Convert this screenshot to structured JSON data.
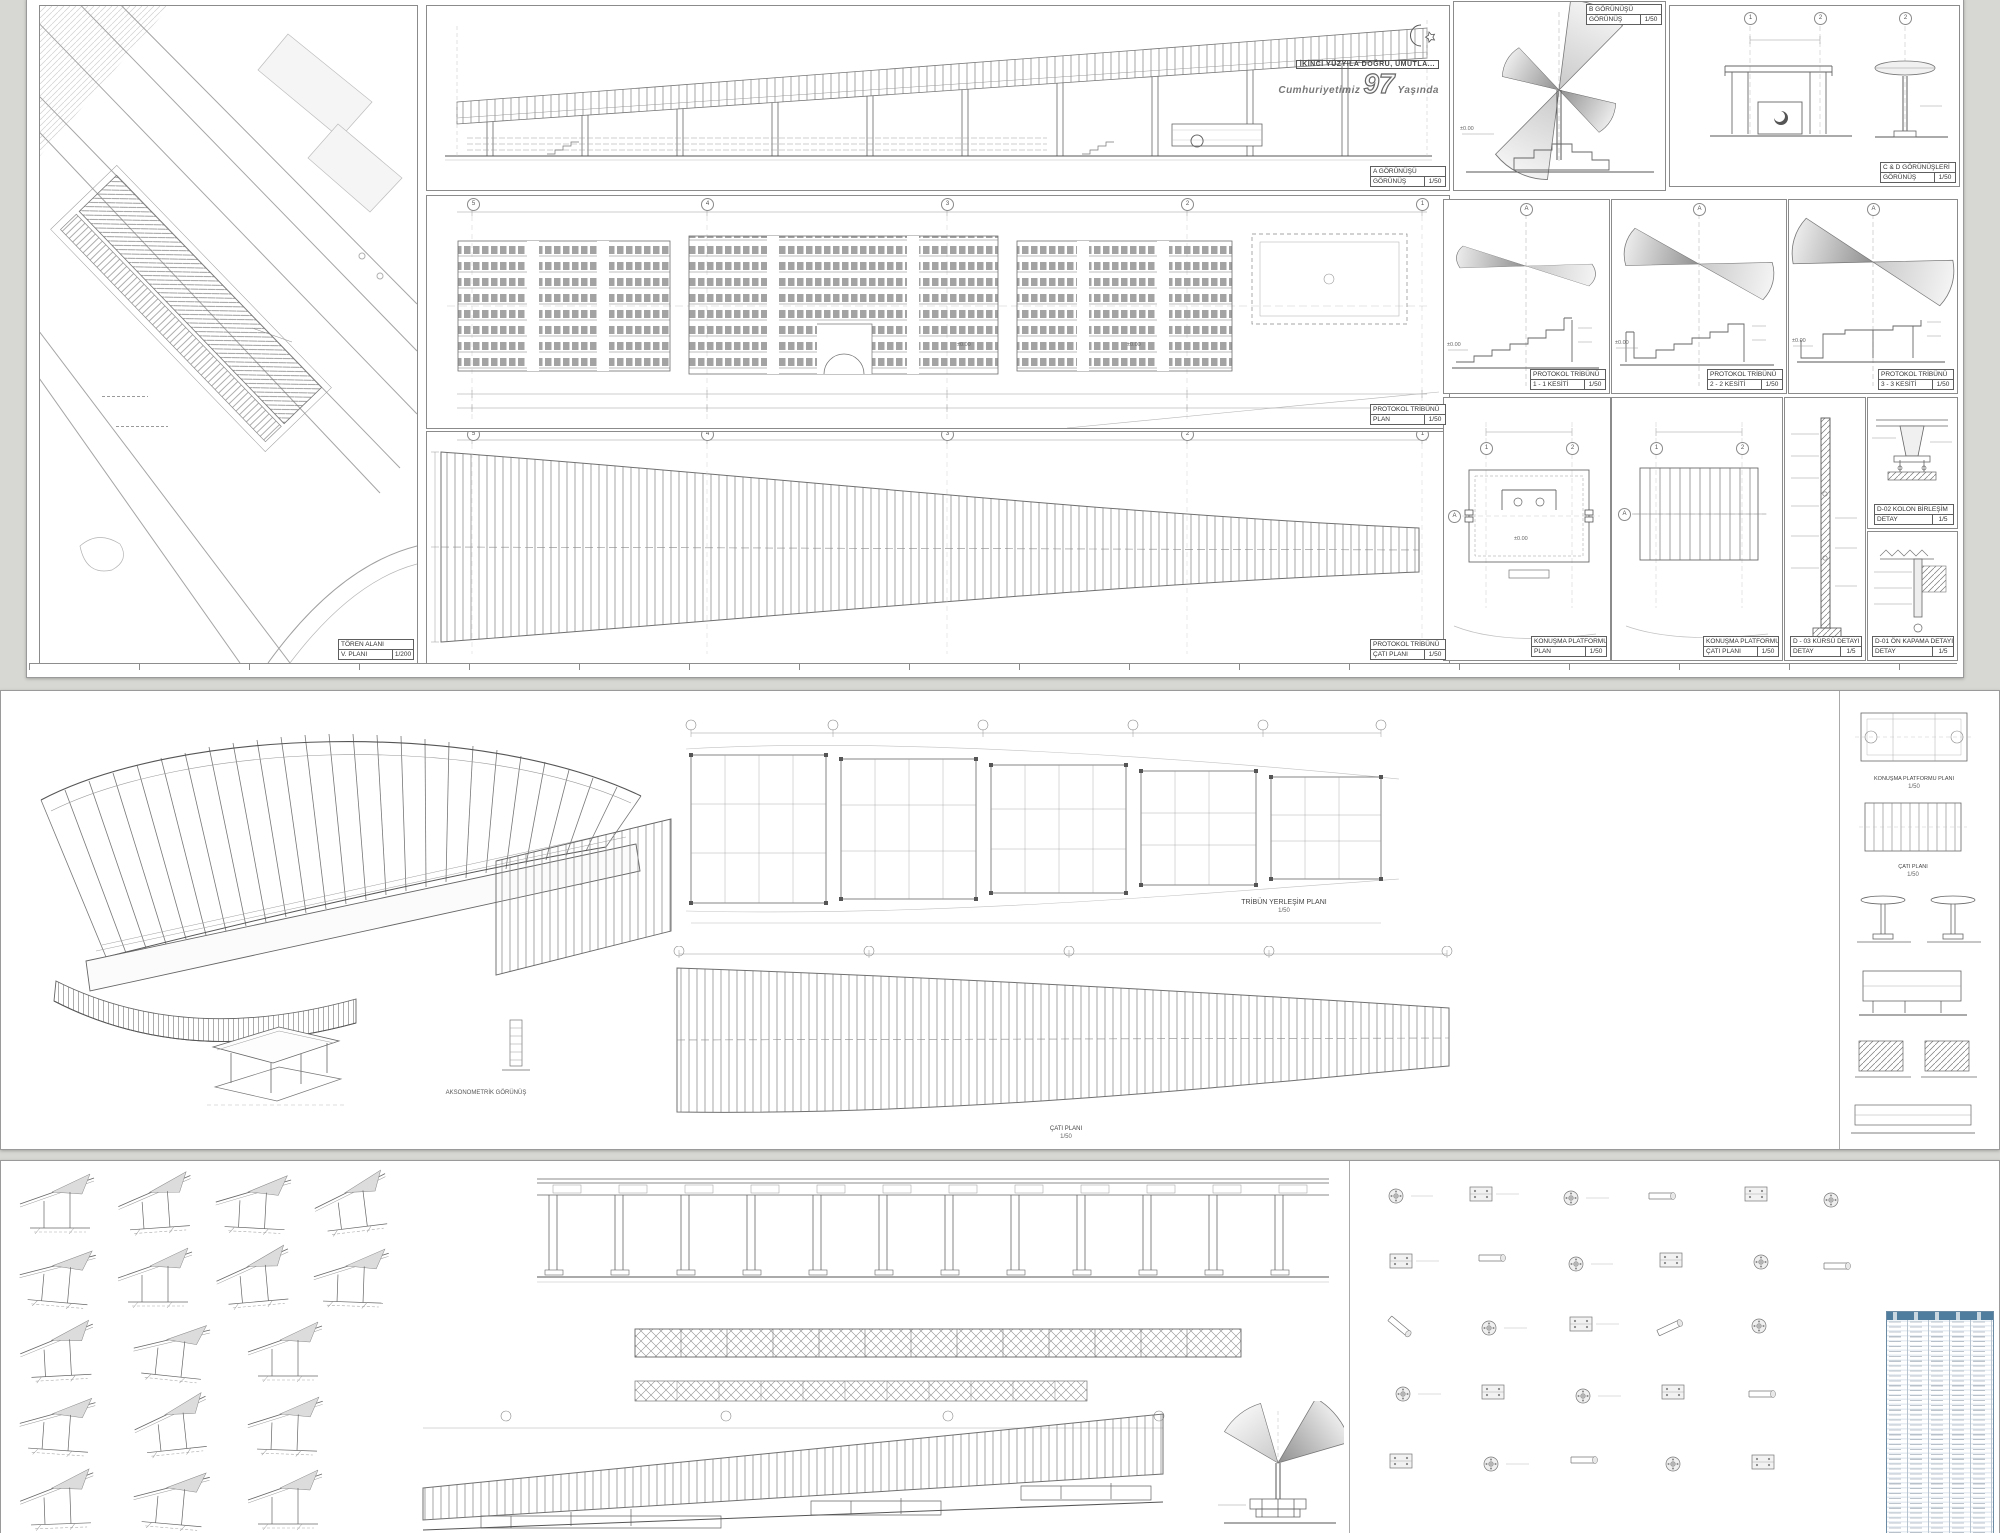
{
  "logo": {
    "slogan": "İKİNCİ YÜZYILA DOĞRU, UMUTLA...",
    "line1": "Cumhuriyetimiz",
    "number": "97",
    "line2": "Yaşında"
  },
  "levels": {
    "zero": "±0.00"
  },
  "sheet1": {
    "site": {
      "title": "TÖREN ALANI",
      "type": "V. PLANI",
      "scale": "1/200"
    },
    "elev_a": {
      "title": "A GÖRÜNÜŞÜ",
      "type": "GÖRÜNÜŞ",
      "scale": "1/50"
    },
    "plan": {
      "title": "PROTOKOL TRİBÜNÜ",
      "type": "PLAN",
      "scale": "1/50"
    },
    "roof": {
      "title": "PROTOKOL TRİBÜNÜ",
      "type": "ÇATI PLANI",
      "scale": "1/50"
    },
    "elev_b": {
      "title": "B GÖRÜNÜŞÜ",
      "type": "GÖRÜNÜŞ",
      "scale": "1/50"
    },
    "elev_cd": {
      "title": "C & D GÖRÜNÜŞLERİ",
      "type": "GÖRÜNÜŞ",
      "scale": "1/50"
    },
    "sec1": {
      "title": "PROTOKOL TRİBÜNÜ",
      "type": "1 - 1 KESİTİ",
      "scale": "1/50"
    },
    "sec2": {
      "title": "PROTOKOL TRİBÜNÜ",
      "type": "2 - 2 KESİTİ",
      "scale": "1/50"
    },
    "sec3": {
      "title": "PROTOKOL TRİBÜNÜ",
      "type": "3 - 3 KESİTİ",
      "scale": "1/50"
    },
    "kp_plan": {
      "title": "KONUŞMA PLATFORMU",
      "type": "PLAN",
      "scale": "1/50"
    },
    "kp_roof": {
      "title": "KONUŞMA PLATFORMU",
      "type": "ÇATI PLANI",
      "scale": "1/50"
    },
    "kursu": {
      "title": "D - 03 KÜRSÜ DETAYI",
      "type": "DETAY",
      "scale": "1/5"
    },
    "kolon": {
      "title": "D-02 KOLON BİRLEŞİM",
      "type": "DETAY",
      "scale": "1/5"
    },
    "kapama": {
      "title": "D-01 ÖN KAPAMA DETAYI",
      "type": "DETAY",
      "scale": "1/5"
    },
    "grid": {
      "g5": "5",
      "g4": "4",
      "g3": "3",
      "g2": "2",
      "g1": "1",
      "axis": "A",
      "p1": "1",
      "p2": "2"
    }
  },
  "sheet2": {
    "akso_label": "AKSONOMETRİK GÖRÜNÜŞ",
    "tribun_plan": {
      "title": "TRİBÜN YERLEŞİM PLANI",
      "scale": "1/50"
    },
    "roof_plan": {
      "title": "ÇATI PLANI",
      "scale": "1/50"
    },
    "kp_plan": {
      "title": "KONUŞMA PLATFORMU PLANI",
      "scale": "1/50"
    },
    "kp_roof": {
      "title": "ÇATI PLANI",
      "scale": "1/50"
    }
  },
  "sheet3": {
    "schedule": {
      "rows": 44,
      "columns": 5,
      "header_color": "#4f7d9e"
    }
  }
}
